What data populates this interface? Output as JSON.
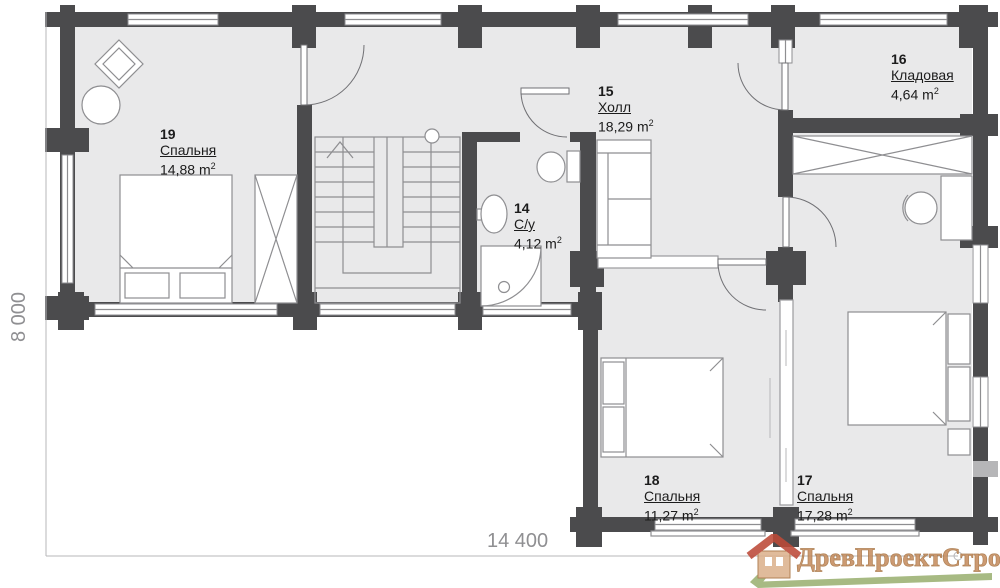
{
  "rooms": [
    {
      "number": "19",
      "name": "Спальня",
      "area": "14,88",
      "unit": "m",
      "sup": "2"
    },
    {
      "number": "14",
      "name": "С/у",
      "area": "4,12",
      "unit": "m",
      "sup": "2"
    },
    {
      "number": "15",
      "name": "Холл",
      "area": "18,29",
      "unit": "m",
      "sup": "2"
    },
    {
      "number": "16",
      "name": "Кладовая",
      "area": "4,64",
      "unit": "m",
      "sup": "2"
    },
    {
      "number": "18",
      "name": "Спальня",
      "area": "11,27",
      "unit": "m",
      "sup": "2"
    },
    {
      "number": "17",
      "name": "Спальня",
      "area": "17,28",
      "unit": "m",
      "sup": "2"
    }
  ],
  "dimensions": {
    "height": "8 000",
    "width": "14 400"
  },
  "watermark": "ДревПроектСтрой",
  "colors": {
    "wall": "#4b4b4d",
    "floor": "#e9e9ea",
    "line": "#8e8e91",
    "lightline": "#b7b7ba",
    "dimtext": "#8f8f92",
    "text": "#1c1c1c",
    "logo_text": "#c68d5f",
    "logo_roof": "#bd4a38",
    "logo_body": "#dcb28e",
    "logo_green": "#9cb173"
  }
}
